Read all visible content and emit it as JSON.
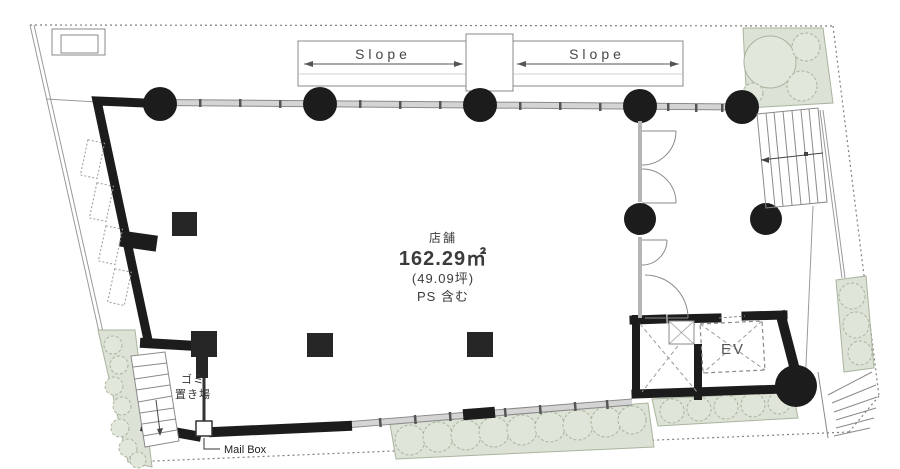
{
  "plan": {
    "labels": {
      "slope_left": "Slope",
      "slope_right": "Slope",
      "unit_name": "店舗",
      "area_m2": "162.29㎡",
      "area_tsubo": "(49.09坪)",
      "ps_note": "PS 含む",
      "elevator": "EV",
      "garbage_line1": "ゴミ",
      "garbage_line2": "置き場",
      "mailbox": "Mail Box"
    },
    "unit": {
      "name": "店舗",
      "area_m2_value": 162.29,
      "area_tsubo_value": 49.09,
      "note": "PS 含む"
    },
    "colors": {
      "wall": "#1c1c1c",
      "glass": "#d4d4d4",
      "line": "#8a8a8a",
      "landscape_fill": "#dce2d5",
      "landscape_stroke": "#a9b49e",
      "boundary": "#7f7f7f",
      "text": "#3b3b3b"
    },
    "icons": {
      "round-column-marker": "filled-circle",
      "square-column-marker": "filled-square",
      "door-swing-icon": "quarter-arc",
      "stair-treads-icon": "parallel-lines",
      "planting-bed-icon": "scalloped-circles",
      "elevator-shaft-icon": "dashed-x-box",
      "dimension-arrow-icon": "double-headed-arrow"
    }
  }
}
